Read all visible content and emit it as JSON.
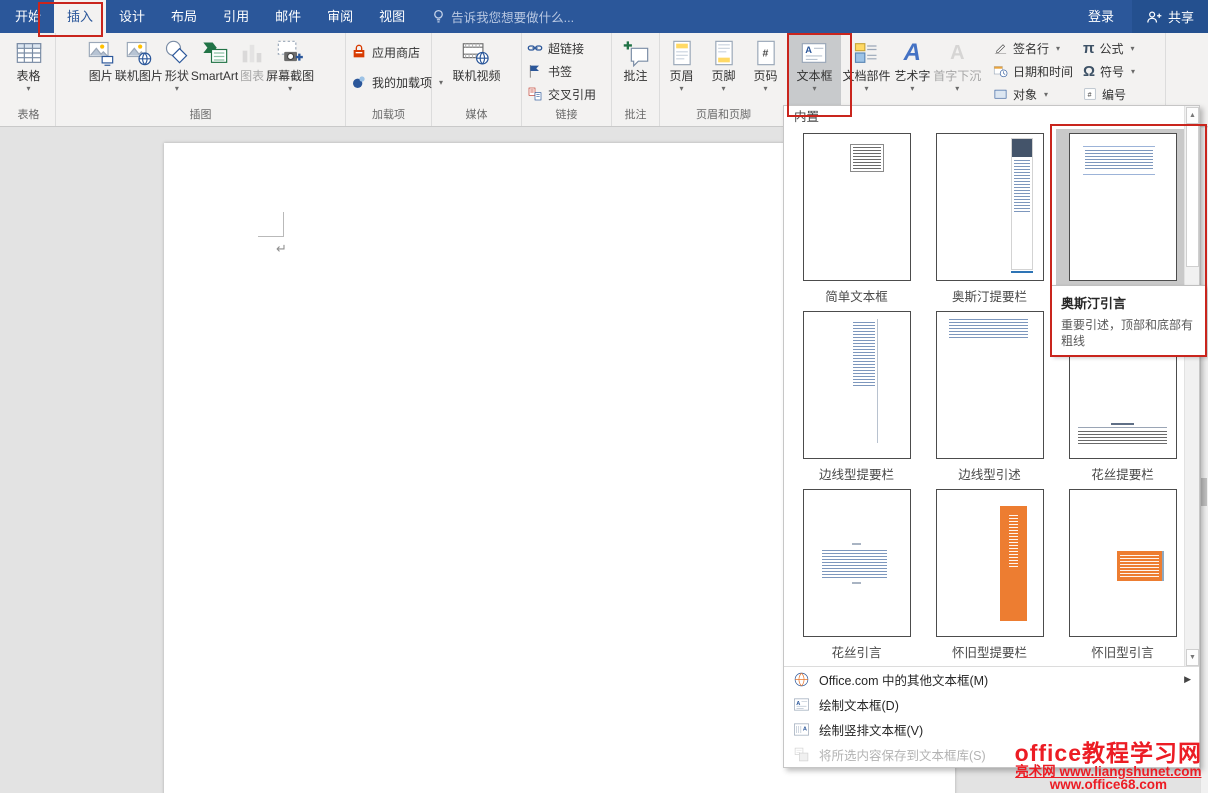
{
  "titlebar": {
    "tabs": [
      "开始",
      "插入",
      "设计",
      "布局",
      "引用",
      "邮件",
      "审阅",
      "视图"
    ],
    "search_placeholder": "告诉我您想要做什么...",
    "sign_in": "登录",
    "share": "共享"
  },
  "ribbon": {
    "table": {
      "button": "表格",
      "label": "表格"
    },
    "illustrations": {
      "label": "插图",
      "pictures": "图片",
      "online_pictures": "联机图片",
      "shapes": "形状",
      "smartart": "SmartArt",
      "chart": "图表",
      "screenshot": "屏幕截图"
    },
    "addins": {
      "label": "加载项",
      "store": "应用商店",
      "my_addins": "我的加载项"
    },
    "media": {
      "label": "媒体",
      "online_video": "联机视频"
    },
    "links": {
      "label": "链接",
      "hyperlink": "超链接",
      "bookmark": "书签",
      "crossref": "交叉引用"
    },
    "comments": {
      "label": "批注",
      "comment": "批注"
    },
    "header_footer": {
      "label": "页眉和页脚",
      "header": "页眉",
      "footer": "页脚",
      "page_number": "页码"
    },
    "text": {
      "textbox": "文本框",
      "quick_parts": "文档部件",
      "wordart": "艺术字",
      "drop_cap": "首字下沉",
      "signature_line": "签名行",
      "date_time": "日期和时间",
      "object": "对象"
    },
    "symbols": {
      "equation": "公式",
      "symbol": "符号",
      "numbering": "编号"
    }
  },
  "document": {
    "pilcrow": "↵"
  },
  "dropdown": {
    "header": "内置",
    "gallery": [
      {
        "name": "简单文本框"
      },
      {
        "name": "奥斯汀提要栏"
      },
      {
        "name": "奥斯汀引言"
      },
      {
        "name": "边线型提要栏"
      },
      {
        "name": "边线型引述"
      },
      {
        "name": "花丝提要栏"
      },
      {
        "name": "花丝引言"
      },
      {
        "name": "怀旧型提要栏"
      },
      {
        "name": "怀旧型引言"
      }
    ],
    "tooltip": {
      "title": "奥斯汀引言",
      "description": "重要引述，顶部和底部有粗线"
    },
    "menu": [
      {
        "label": "Office.com 中的其他文本框(M)"
      },
      {
        "label": "绘制文本框(D)"
      },
      {
        "label": "绘制竖排文本框(V)"
      },
      {
        "label": "将所选内容保存到文本框库(S)"
      }
    ]
  },
  "watermark": {
    "line1": "office教程学习网",
    "line2": "亮术网 www.liangshunet.com",
    "line3": "www.office68.com"
  },
  "colors": {
    "titlebar_blue": "#2b579a",
    "annotation_red": "#c9251d",
    "thumbnail_orange": "#ed7d31",
    "sidebar_navy": "#44546a",
    "watermark_red": "#ec1c24"
  }
}
